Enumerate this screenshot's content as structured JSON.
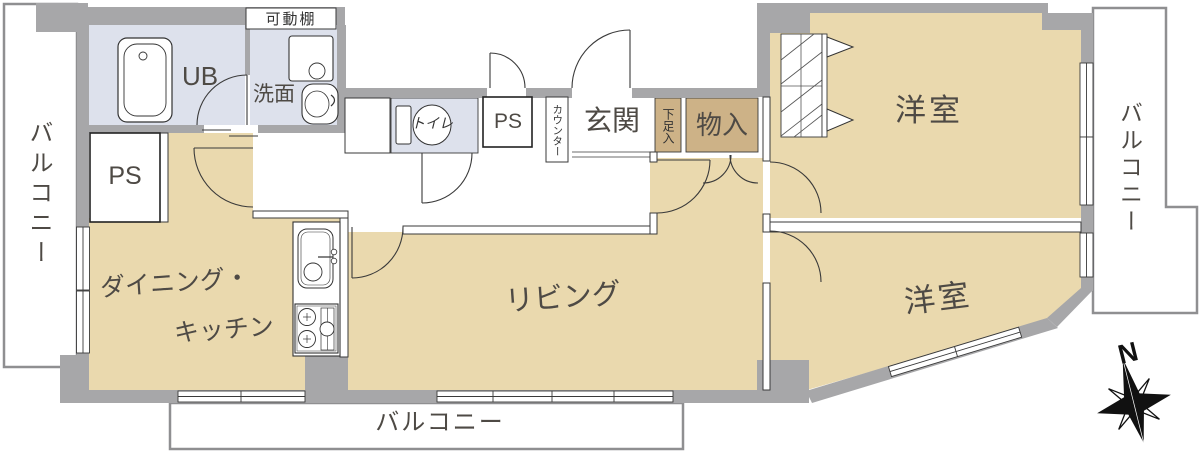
{
  "plan": {
    "labels": {
      "balcony_left": "バルコニー",
      "balcony_right": "バルコニー",
      "balcony_bottom": "バルコニー",
      "ps_left": "PS",
      "ps_center": "PS",
      "unit_bath": "UB",
      "movable_shelf": "可動棚",
      "washroom": "洗面",
      "toilet": "トイレ",
      "counter": "カウンター",
      "entrance": "玄関",
      "shoe_cabinet": "下足入",
      "storage": "物入",
      "bedroom_top": "洋室",
      "bedroom_bottom": "洋室",
      "dining_kitchen_line1": "ダイニング・",
      "dining_kitchen_line2": "キッチン",
      "living": "リビング",
      "compass_north": "N"
    },
    "colors": {
      "wall": "#a7a7a9",
      "floor": "#ead9ae",
      "wet_area": "#dde1ec",
      "storage_fill": "#cdb287",
      "line": "#3a3a3a",
      "balcony_outline": "#8f8f91",
      "label_text": "#4e4a45"
    }
  }
}
